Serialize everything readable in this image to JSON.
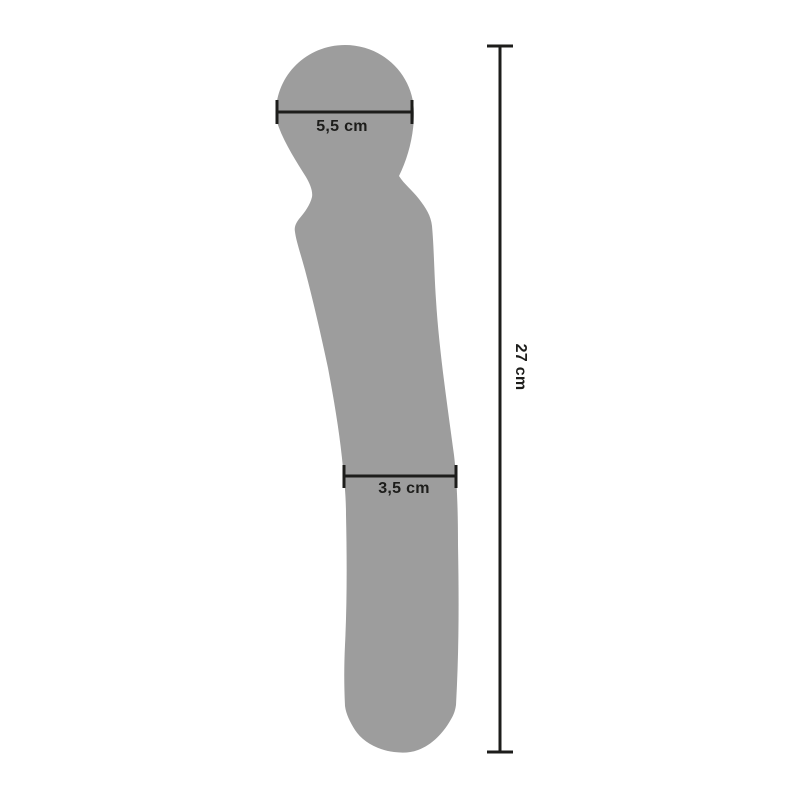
{
  "diagram": {
    "measurements": {
      "head_width": {
        "label": "5,5 cm",
        "value_cm": 5.5,
        "orientation": "horizontal"
      },
      "shaft_width": {
        "label": "3,5 cm",
        "value_cm": 3.5,
        "orientation": "horizontal"
      },
      "total_length": {
        "label": "27 cm",
        "value_cm": 27,
        "orientation": "vertical"
      }
    },
    "colors": {
      "background": "#ffffff",
      "silhouette": "#9d9d9d",
      "dimension_line": "#1d1d1b",
      "text": "#1d1d1b"
    }
  }
}
